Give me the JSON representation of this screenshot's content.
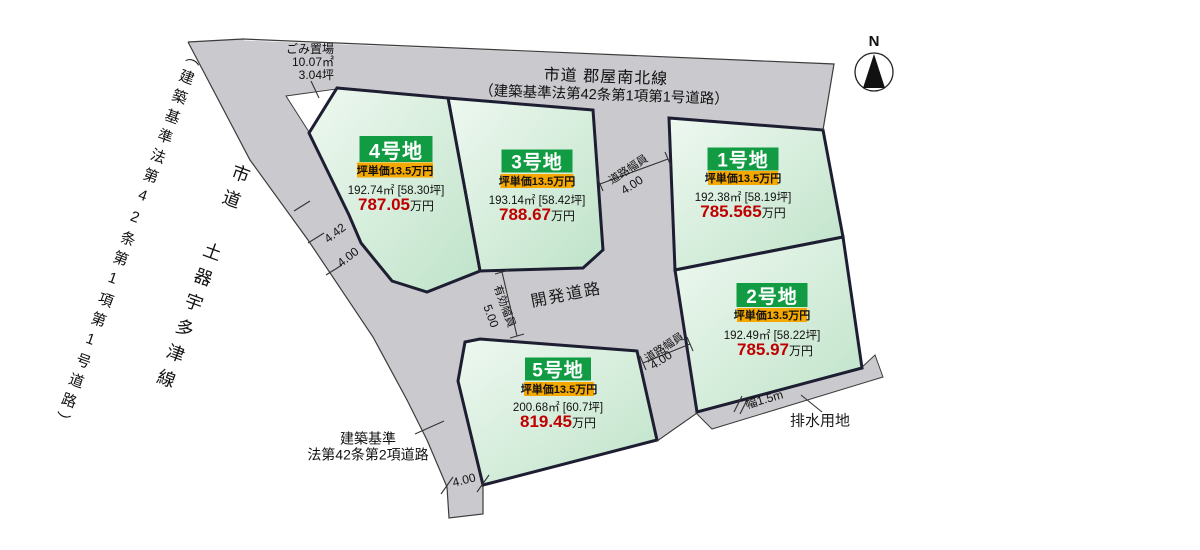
{
  "title": "区画図",
  "colors": {
    "road_gray": "#c9c9ce",
    "plot_green_light": "#eef8f0",
    "plot_green_dark": "#bfe3c9",
    "plot_border": "#1e1e32",
    "header_green": "#119c44",
    "unit_yellow": "#f5a800",
    "price_red": "#c00000"
  },
  "compass": {
    "north_label": "N"
  },
  "roads": {
    "top_road": {
      "name": "市道 郡屋南北線",
      "law": "（建築基準法第42条第1項第1号道路）"
    },
    "left_road": {
      "name": "市道 土器宇多津線",
      "law": "（建築基準法第42条第1項第1号道路）"
    },
    "dev_road": {
      "name": "開発道路"
    },
    "bottom_road": {
      "line1": "建築基準",
      "line2": "法第42条第2項道路"
    },
    "drainage": {
      "name": "排水用地",
      "width_label": "幅1.5m"
    }
  },
  "garbage_area": {
    "line1": "ごみ置場",
    "line2": "10.07㎡",
    "line3": "3.04坪"
  },
  "dimensions": {
    "left_442": "4.42",
    "left_400": "4.00",
    "bottom_400": "4.00",
    "effective_width_label": "有効幅員",
    "effective_width_value": "5.00",
    "road_width_label_upper": "道路幅員",
    "road_width_value_upper": "4.00",
    "road_width_label_lower": "道路幅員",
    "road_width_value_lower": "4.00"
  },
  "plots": [
    {
      "name": "1号地",
      "unit_price": "坪単価13.5万円",
      "area": "192.38㎡ [58.19坪]",
      "price": "785.565",
      "price_suffix": "万円"
    },
    {
      "name": "2号地",
      "unit_price": "坪単価13.5万円",
      "area": "192.49㎡ [58.22坪]",
      "price": "785.97",
      "price_suffix": "万円"
    },
    {
      "name": "3号地",
      "unit_price": "坪単価13.5万円",
      "area": "193.14㎡ [58.42坪]",
      "price": "788.67",
      "price_suffix": "万円"
    },
    {
      "name": "4号地",
      "unit_price": "坪単価13.5万円",
      "area": "192.74㎡ [58.30坪]",
      "price": "787.05",
      "price_suffix": "万円"
    },
    {
      "name": "5号地",
      "unit_price": "坪単価13.5万円",
      "area": "200.68㎡ [60.7坪]",
      "price": "819.45",
      "price_suffix": "万円"
    }
  ]
}
